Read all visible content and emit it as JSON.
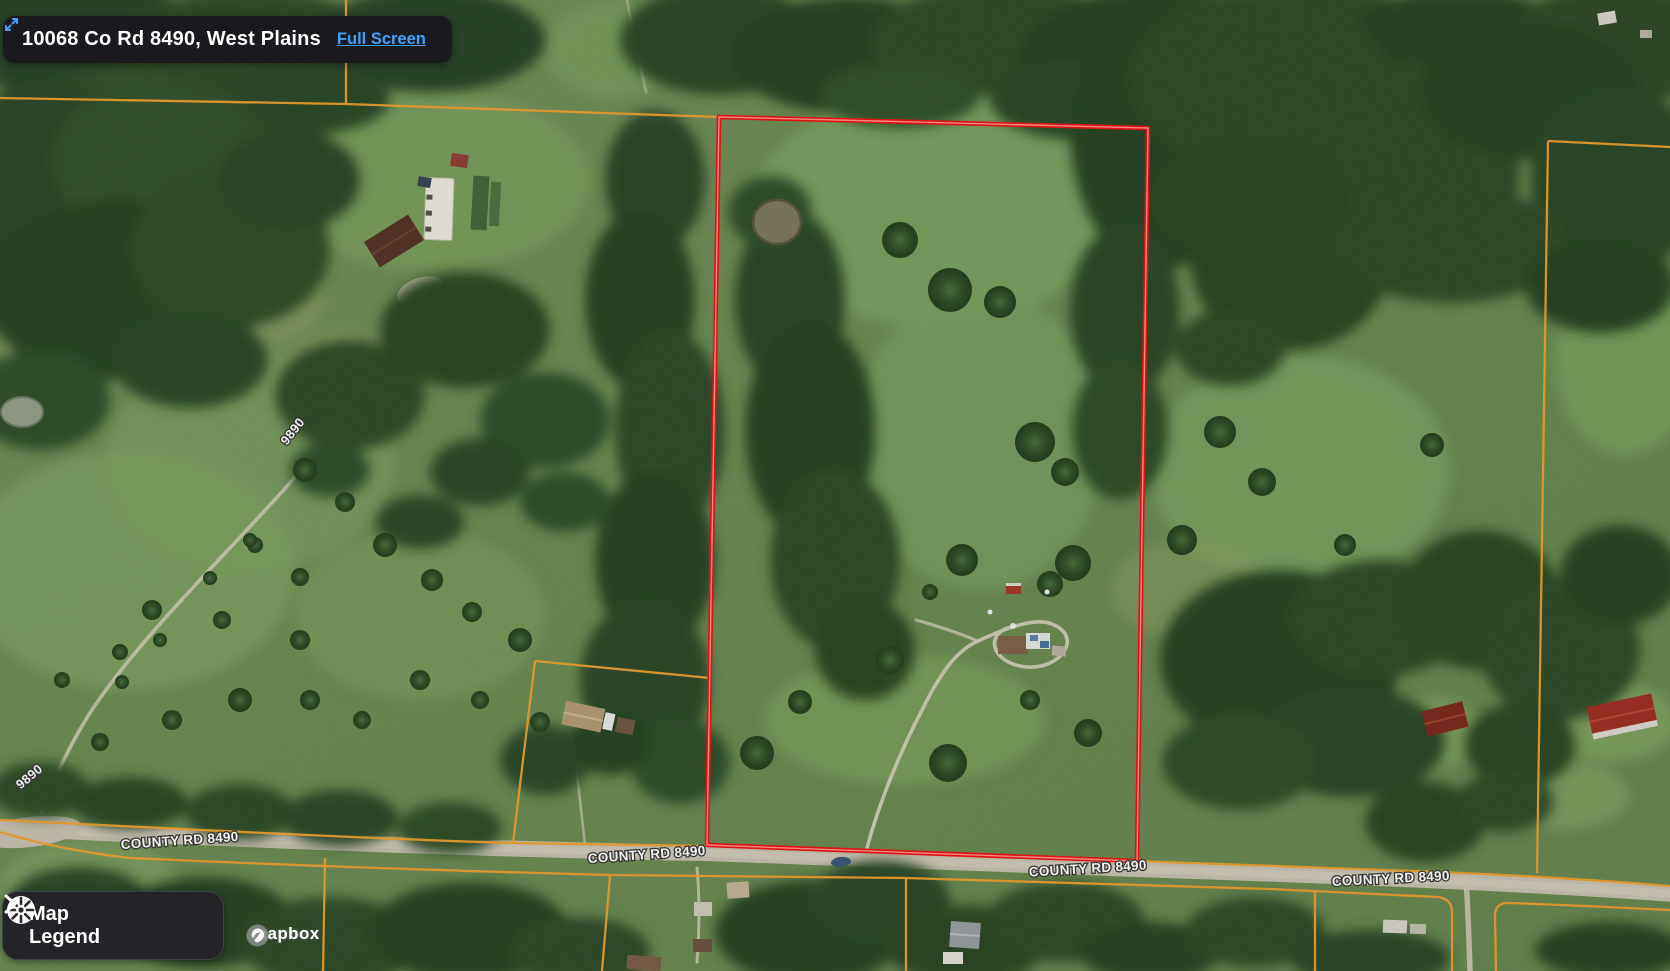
{
  "header": {
    "address": "10068 Co Rd 8490, West Plains",
    "full_screen": "Full Screen"
  },
  "legend": {
    "line1": "Map",
    "line2": "Legend"
  },
  "attribution": {
    "brand": "mapbox"
  },
  "map": {
    "road_labels": [
      {
        "text": "COUNTY RD 8490"
      },
      {
        "text": "COUNTY RD 8490"
      },
      {
        "text": "COUNTY RD 8490"
      },
      {
        "text": "COUNTY RD 8490"
      }
    ],
    "side_labels": [
      {
        "text": "9890"
      },
      {
        "text": "9890"
      }
    ],
    "colors": {
      "parcel_red": "#ee1414",
      "parcel_red_core": "#ffa0a0",
      "boundary_orange": "#eea231",
      "label_fill": "#ffffff",
      "link_blue": "#3fa2ff"
    }
  }
}
